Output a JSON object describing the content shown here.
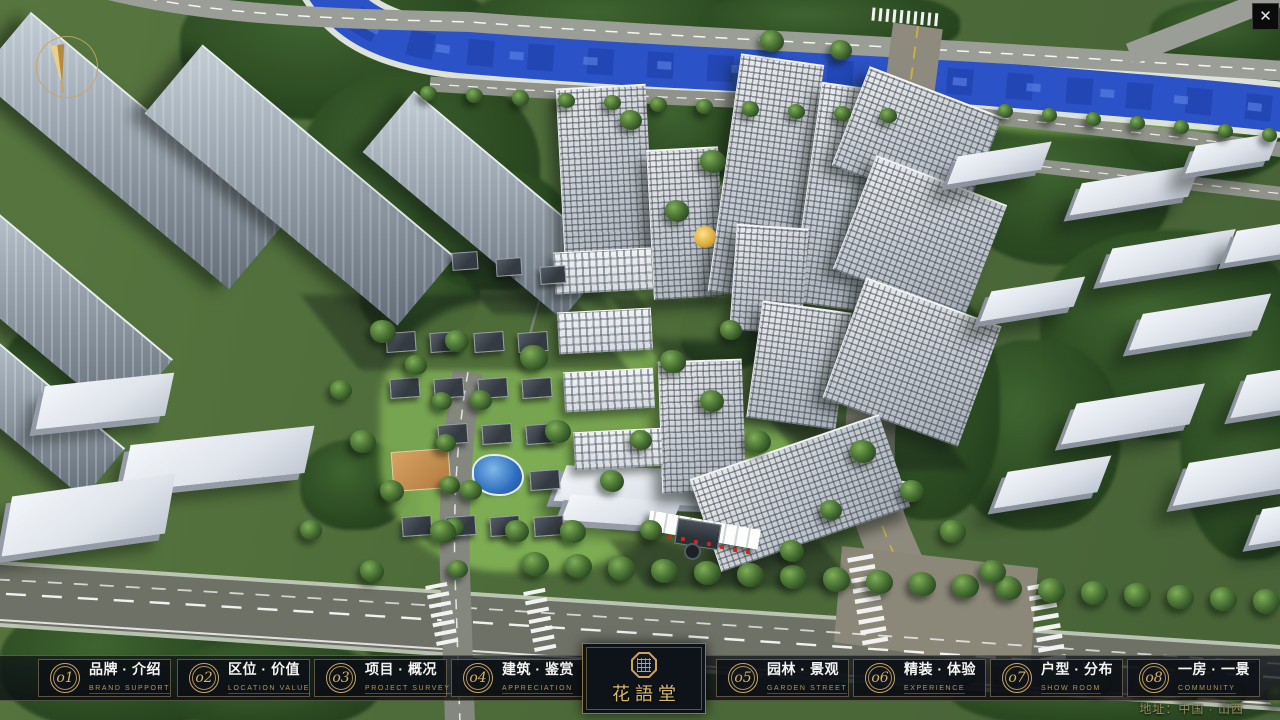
{
  "window": {
    "close_glyph": "✕"
  },
  "nav": {
    "items": [
      {
        "num": "o1",
        "title": "品牌 · 介绍",
        "subtitle": "BRAND SUPPORT"
      },
      {
        "num": "o2",
        "title": "区位 · 价值",
        "subtitle": "LOCATION VALUE"
      },
      {
        "num": "o3",
        "title": "项目 · 概况",
        "subtitle": "PROJECT SURVEY"
      },
      {
        "num": "o4",
        "title": "建筑 · 鉴赏",
        "subtitle": "APPRECIATION"
      },
      {
        "num": "o5",
        "title": "园林 · 景观",
        "subtitle": "GARDEN STREET"
      },
      {
        "num": "o6",
        "title": "精装 · 体验",
        "subtitle": "EXPERIENCE"
      },
      {
        "num": "o7",
        "title": "户型 · 分布",
        "subtitle": "SHOW ROOM"
      },
      {
        "num": "o8",
        "title": "一房 · 一景",
        "subtitle": "COMMUNITY"
      }
    ]
  },
  "logo": {
    "name": "花語堂"
  },
  "footer": {
    "address": "地址：中国 · 山西"
  },
  "icons": [
    "compass-north-icon",
    "close-icon",
    "seal-icon",
    "nav-number-badge"
  ],
  "colors": {
    "accent_gold": "#c9a667",
    "panel_dark": "#0e1319",
    "river_blue": "#2b52c6",
    "road_grey": "#6e7166",
    "ground_green": "#4d6b39"
  }
}
